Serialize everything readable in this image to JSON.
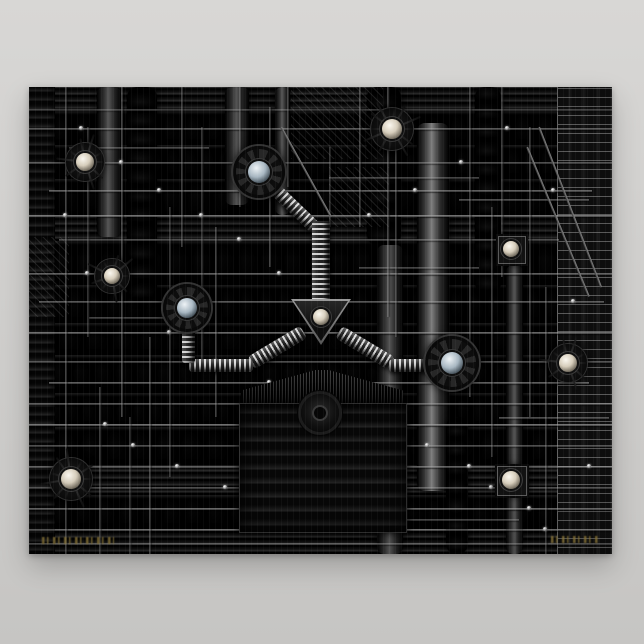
{
  "scene": {
    "background": {
      "top": "#d8d7d5",
      "bottom": "#c6c5c3"
    },
    "poster": {
      "x": 29,
      "y": 87,
      "w": 583,
      "h": 467,
      "base": "#0b0b0b"
    },
    "palette": {
      "gold": "#97803c",
      "metal_warm": "#e9e0cf",
      "metal_cool": "#dce4ea",
      "line": "#9a9a9a"
    },
    "bands": [
      {
        "y": 0,
        "h": 24,
        "t": "slat"
      },
      {
        "y": 24,
        "h": 34,
        "t": "cap",
        "cw": 22
      },
      {
        "y": 58,
        "h": 34,
        "t": "cap",
        "cw": 17
      },
      {
        "y": 92,
        "h": 38,
        "t": "cap",
        "cw": 26
      },
      {
        "y": 130,
        "h": 24,
        "t": "slat"
      },
      {
        "y": 154,
        "h": 44,
        "t": "cap",
        "cw": 23
      },
      {
        "y": 198,
        "h": 38,
        "t": "cap",
        "cw": 19
      },
      {
        "y": 236,
        "h": 32,
        "t": "cap",
        "cw": 27
      },
      {
        "y": 268,
        "h": 38,
        "t": "cap",
        "cw": 21
      },
      {
        "y": 306,
        "h": 34,
        "t": "cap",
        "cw": 17
      },
      {
        "y": 340,
        "h": 38,
        "t": "cap",
        "cw": 25
      },
      {
        "y": 378,
        "h": 30,
        "t": "slat"
      },
      {
        "y": 408,
        "h": 34,
        "t": "cap",
        "cw": 22
      },
      {
        "y": 442,
        "h": 25,
        "t": "slat"
      }
    ],
    "columns": [
      {
        "x": 0,
        "y": 0,
        "w": 26,
        "h": 467,
        "t": "slats"
      },
      {
        "x": 68,
        "y": 0,
        "w": 24,
        "h": 150,
        "t": "pipe"
      },
      {
        "x": 98,
        "y": 0,
        "w": 30,
        "h": 214,
        "t": "beads"
      },
      {
        "x": 196,
        "y": 0,
        "w": 24,
        "h": 118,
        "t": "pipe"
      },
      {
        "x": 246,
        "y": 0,
        "w": 15,
        "h": 128,
        "t": "pipe"
      },
      {
        "x": 338,
        "y": 0,
        "w": 34,
        "h": 158,
        "t": "beads"
      },
      {
        "x": 348,
        "y": 158,
        "w": 26,
        "h": 309,
        "t": "pipe"
      },
      {
        "x": 388,
        "y": 36,
        "w": 32,
        "h": 368,
        "t": "pipeb"
      },
      {
        "x": 417,
        "y": 330,
        "w": 22,
        "h": 137,
        "t": "beads"
      },
      {
        "x": 446,
        "y": 0,
        "w": 26,
        "h": 206,
        "t": "beads"
      },
      {
        "x": 477,
        "y": 178,
        "w": 17,
        "h": 289,
        "t": "pipe"
      },
      {
        "x": 528,
        "y": 0,
        "w": 55,
        "h": 467,
        "t": "ladder"
      }
    ],
    "hatches": [
      {
        "x": 262,
        "y": 0,
        "w": 92,
        "h": 72
      },
      {
        "x": 300,
        "y": 80,
        "w": 60,
        "h": 60
      },
      {
        "x": 0,
        "y": 150,
        "w": 40,
        "h": 80
      }
    ],
    "h_wires": [
      [
        0,
        22,
        583,
        0.35
      ],
      [
        0,
        41,
        583,
        0.5
      ],
      [
        40,
        60,
        140,
        0.4
      ],
      [
        0,
        75,
        583,
        0.45
      ],
      [
        20,
        103,
        543,
        0.55
      ],
      [
        300,
        90,
        150,
        0.4
      ],
      [
        0,
        128,
        583,
        0.65
      ],
      [
        30,
        152,
        500,
        0.45
      ],
      [
        430,
        112,
        130,
        0.45
      ],
      [
        0,
        186,
        583,
        0.55
      ],
      [
        10,
        214,
        565,
        0.5
      ],
      [
        60,
        230,
        120,
        0.4
      ],
      [
        0,
        245,
        583,
        0.6
      ],
      [
        0,
        274,
        583,
        0.45
      ],
      [
        20,
        295,
        540,
        0.55
      ],
      [
        0,
        316,
        583,
        0.5
      ],
      [
        0,
        337,
        583,
        0.65
      ],
      [
        0,
        358,
        583,
        0.45
      ],
      [
        0,
        379,
        583,
        0.55
      ],
      [
        0,
        400,
        583,
        0.45
      ],
      [
        0,
        421,
        583,
        0.6
      ],
      [
        240,
        432,
        250,
        0.4
      ],
      [
        0,
        442,
        583,
        0.5
      ],
      [
        0,
        456,
        583,
        0.45
      ],
      [
        330,
        180,
        120,
        0.4
      ],
      [
        470,
        330,
        110,
        0.45
      ]
    ],
    "v_wires": [
      [
        36,
        0,
        467,
        0.4
      ],
      [
        58,
        40,
        210,
        0.35
      ],
      [
        92,
        0,
        330,
        0.45
      ],
      [
        120,
        250,
        217,
        0.4
      ],
      [
        140,
        120,
        270,
        0.35
      ],
      [
        152,
        0,
        160,
        0.4
      ],
      [
        172,
        40,
        240,
        0.35
      ],
      [
        186,
        140,
        190,
        0.4
      ],
      [
        210,
        0,
        120,
        0.35
      ],
      [
        240,
        20,
        160,
        0.4
      ],
      [
        258,
        0,
        100,
        0.35
      ],
      [
        300,
        60,
        80,
        0.3
      ],
      [
        330,
        0,
        140,
        0.4
      ],
      [
        358,
        0,
        230,
        0.45
      ],
      [
        366,
        60,
        190,
        0.35
      ],
      [
        440,
        0,
        310,
        0.4
      ],
      [
        462,
        120,
        250,
        0.35
      ],
      [
        472,
        0,
        190,
        0.4
      ],
      [
        500,
        40,
        290,
        0.4
      ],
      [
        516,
        200,
        267,
        0.35
      ],
      [
        70,
        300,
        167,
        0.4
      ],
      [
        100,
        330,
        137,
        0.35
      ]
    ],
    "dots": [
      [
        52,
        41
      ],
      [
        92,
        75
      ],
      [
        130,
        103
      ],
      [
        172,
        128
      ],
      [
        210,
        152
      ],
      [
        250,
        186
      ],
      [
        296,
        214
      ],
      [
        36,
        128
      ],
      [
        58,
        186
      ],
      [
        140,
        245
      ],
      [
        186,
        274
      ],
      [
        240,
        295
      ],
      [
        330,
        316
      ],
      [
        358,
        337
      ],
      [
        398,
        358
      ],
      [
        440,
        379
      ],
      [
        462,
        400
      ],
      [
        500,
        421
      ],
      [
        516,
        442
      ],
      [
        76,
        337
      ],
      [
        104,
        358
      ],
      [
        148,
        379
      ],
      [
        196,
        400
      ],
      [
        244,
        421
      ],
      [
        292,
        442
      ],
      [
        340,
        128
      ],
      [
        386,
        103
      ],
      [
        432,
        75
      ],
      [
        478,
        41
      ],
      [
        524,
        103
      ],
      [
        544,
        214
      ],
      [
        560,
        379
      ]
    ],
    "cables": [
      {
        "x1": 498,
        "y1": 60,
        "x2": 560,
        "y2": 210
      },
      {
        "x1": 510,
        "y1": 40,
        "x2": 572,
        "y2": 200
      },
      {
        "x1": 252,
        "y1": 40,
        "x2": 302,
        "y2": 130
      }
    ],
    "center": {
      "diag_tubes": [
        {
          "x1": 236,
          "y1": 92,
          "x2": 286,
          "y2": 140,
          "w": 13
        },
        {
          "x1": 222,
          "y1": 276,
          "x2": 274,
          "y2": 245,
          "w": 14
        },
        {
          "x1": 310,
          "y1": 245,
          "x2": 362,
          "y2": 276,
          "w": 14
        }
      ],
      "rib_h": [
        {
          "x": 160,
          "y": 272,
          "w": 64,
          "h": 13
        },
        {
          "x": 360,
          "y": 272,
          "w": 62,
          "h": 13
        }
      ],
      "rib_v": [
        {
          "x": 153,
          "y": 230,
          "w": 13,
          "h": 46
        },
        {
          "x": 283,
          "y": 134,
          "w": 18,
          "h": 84
        }
      ],
      "triangle": {
        "x": 262,
        "y": 212,
        "w": 60,
        "h": 46
      },
      "tri_ball": {
        "x": 292,
        "y": 230,
        "r": 8
      },
      "tent": {
        "x": 212,
        "y": 283,
        "w": 162,
        "h": 33
      },
      "panel": {
        "x": 210,
        "y": 316,
        "w": 166,
        "h": 128
      },
      "hub": {
        "x": 291,
        "y": 326,
        "r": 19
      }
    },
    "gears": [
      {
        "x": 230,
        "y": 85,
        "r": 26
      },
      {
        "x": 158,
        "y": 221,
        "r": 24
      },
      {
        "x": 423,
        "y": 276,
        "r": 27
      }
    ],
    "spiders": [
      {
        "x": 56,
        "y": 75,
        "r": 9,
        "legs": 10
      },
      {
        "x": 83,
        "y": 189,
        "r": 8,
        "legs": 9
      },
      {
        "x": 42,
        "y": 392,
        "r": 10,
        "legs": 11
      },
      {
        "x": 363,
        "y": 42,
        "r": 10,
        "legs": 12
      },
      {
        "x": 539,
        "y": 276,
        "r": 9,
        "legs": 10
      }
    ],
    "mounts": [
      {
        "x": 482,
        "y": 162,
        "s": 26,
        "r": 8
      },
      {
        "x": 482,
        "y": 393,
        "s": 28,
        "r": 9
      }
    ],
    "signatures": [
      {
        "x": 13,
        "y": 450,
        "w": 72,
        "h": 7
      },
      {
        "x": 522,
        "y": 449,
        "w": 48,
        "h": 7
      }
    ]
  }
}
